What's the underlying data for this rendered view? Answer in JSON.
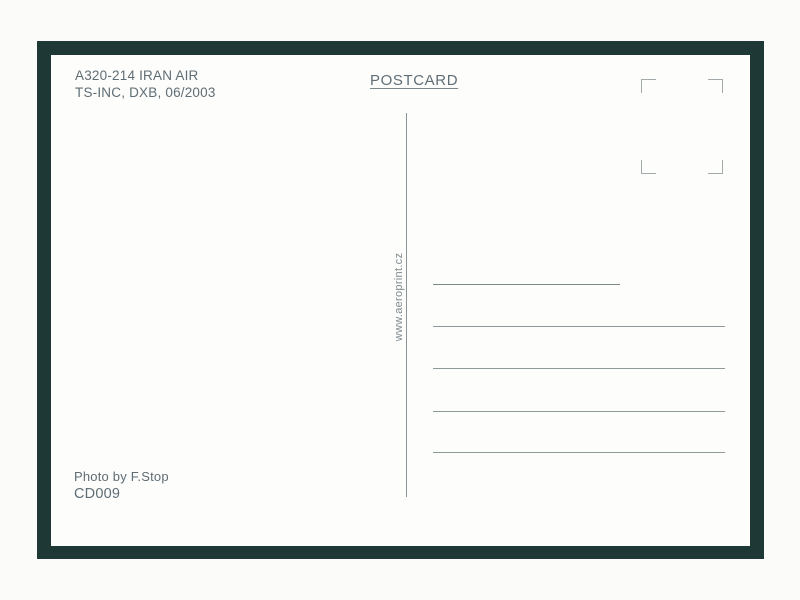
{
  "postcard": {
    "caption_line1": "A320-214 IRAN AIR",
    "caption_line2": "TS-INC, DXB, 06/2003",
    "title": "POSTCARD",
    "watermark": "www.aeroprint.cz",
    "credit_line1": "Photo by F.Stop",
    "credit_line2": "CD009"
  },
  "address_lines": [
    "short",
    "long",
    "long",
    "long",
    "long"
  ],
  "colors": {
    "frame": "#1e3835",
    "card": "#fdfdfc",
    "ink": "#5f6d74",
    "rule": "#8f999b",
    "stamp_marks": "#a3aaac"
  }
}
